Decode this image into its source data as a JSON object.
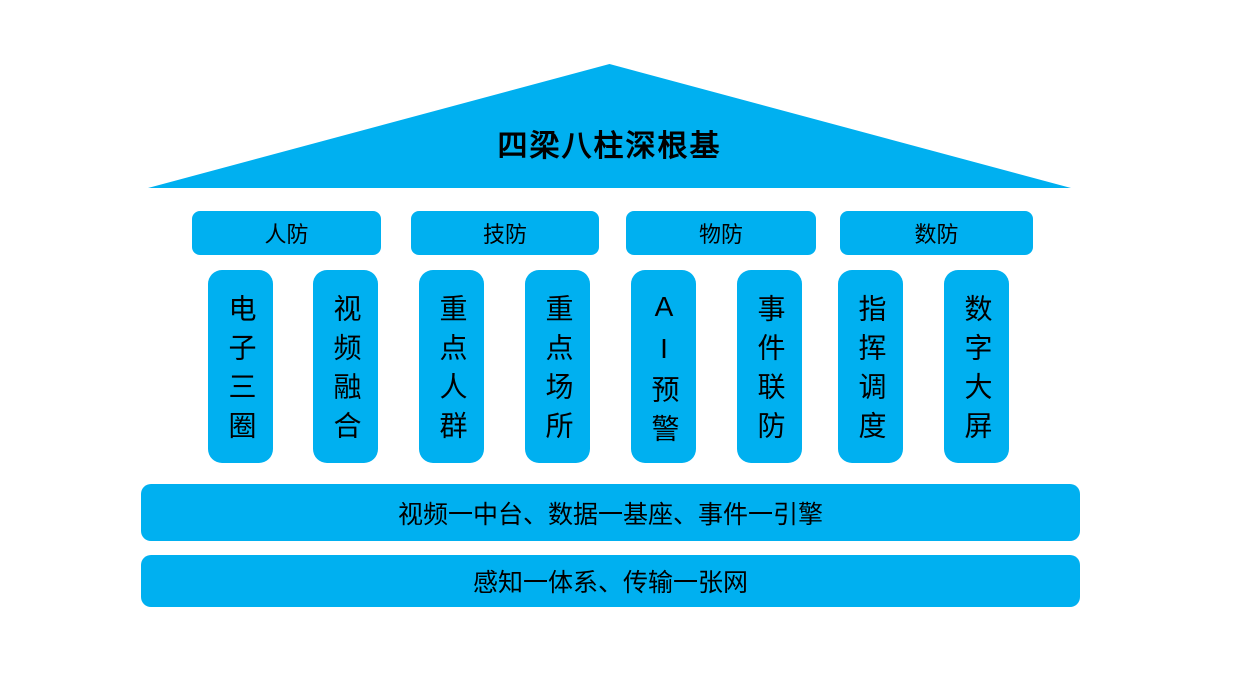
{
  "diagram": {
    "title": "四梁八柱深根基",
    "beams": [
      {
        "label": "人防"
      },
      {
        "label": "技防"
      },
      {
        "label": "物防"
      },
      {
        "label": "数防"
      }
    ],
    "pillars": [
      {
        "label": "电子三圈"
      },
      {
        "label": "视频融合"
      },
      {
        "label": "重点人群"
      },
      {
        "label": "重点场所"
      },
      {
        "label": "AI预警"
      },
      {
        "label": "事件联防"
      },
      {
        "label": "指挥调度"
      },
      {
        "label": "数字大屏"
      }
    ],
    "foundations": [
      {
        "label": "视频一中台、数据一基座、事件一引擎"
      },
      {
        "label": "感知一体系、传输一张网"
      }
    ],
    "colors": {
      "primary": "#00b0f0",
      "text": "#000000",
      "background": "#ffffff"
    }
  }
}
